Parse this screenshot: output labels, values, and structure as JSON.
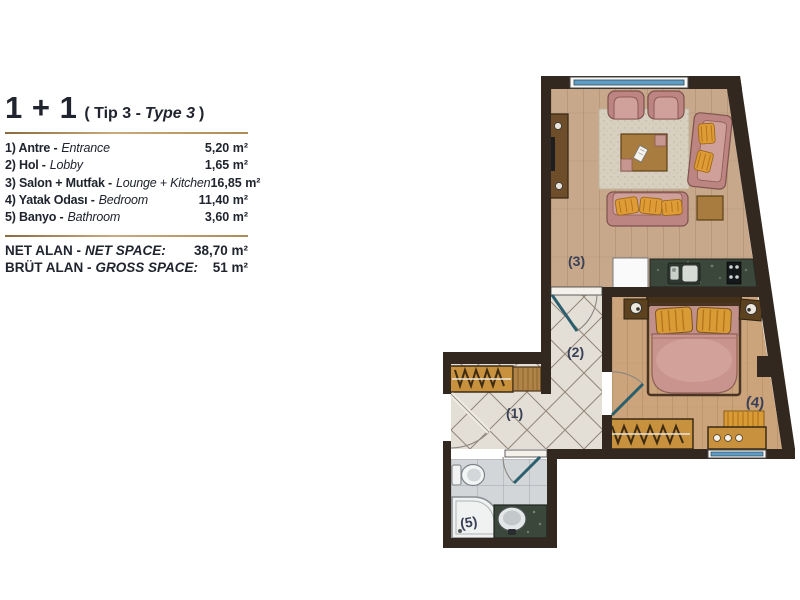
{
  "legend": {
    "title": "1 + 1",
    "subtitle_prefix": "( Tip 3 -",
    "subtitle_type": "Type 3",
    "subtitle_suffix": ")",
    "rows": [
      {
        "label_tr": "1) Antre -",
        "label_en": "Entrance",
        "area": "5,20 m²"
      },
      {
        "label_tr": "2) Hol -",
        "label_en": "Lobby",
        "area": "1,65 m²"
      },
      {
        "label_tr": "3) Salon + Mutfak -",
        "label_en": "Lounge + Kitchen",
        "area": "16,85 m²"
      },
      {
        "label_tr": "4) Yatak Odası -",
        "label_en": "Bedroom",
        "area": "11,40 m²"
      },
      {
        "label_tr": "5) Banyo -",
        "label_en": "Bathroom",
        "area": "3,60 m²"
      }
    ],
    "totals": [
      {
        "label_tr": "NET ALAN -",
        "label_en": "NET SPACE:",
        "area": "38,70 m²"
      },
      {
        "label_tr": "BRÜT ALAN -",
        "label_en": "GROSS SPACE:",
        "area": "51 m²"
      }
    ],
    "accent_color": "#bf9e6f",
    "text_color": "#20242e"
  },
  "plan": {
    "room_labels": {
      "r1": "(1)",
      "r2": "(2)",
      "r3": "(3)",
      "r4": "(4)",
      "r5": "(5)"
    },
    "colors": {
      "wall": "#32281f",
      "wood_living": "#c7a88a",
      "wood_bedroom": "#cba47c",
      "tile_hall": "#e3ded6",
      "tile_bath": "#d3d6d8",
      "rug": "#d7cfc0",
      "sofa_pink": "#bc8581",
      "cushion_orange": "#df9b36",
      "furniture_wood": "#c8913d",
      "counter_marble": "#3c473c",
      "window_glass": "#5f9dc4",
      "door_glass": "#2c5f6d",
      "room_label": "#3a4156"
    }
  }
}
